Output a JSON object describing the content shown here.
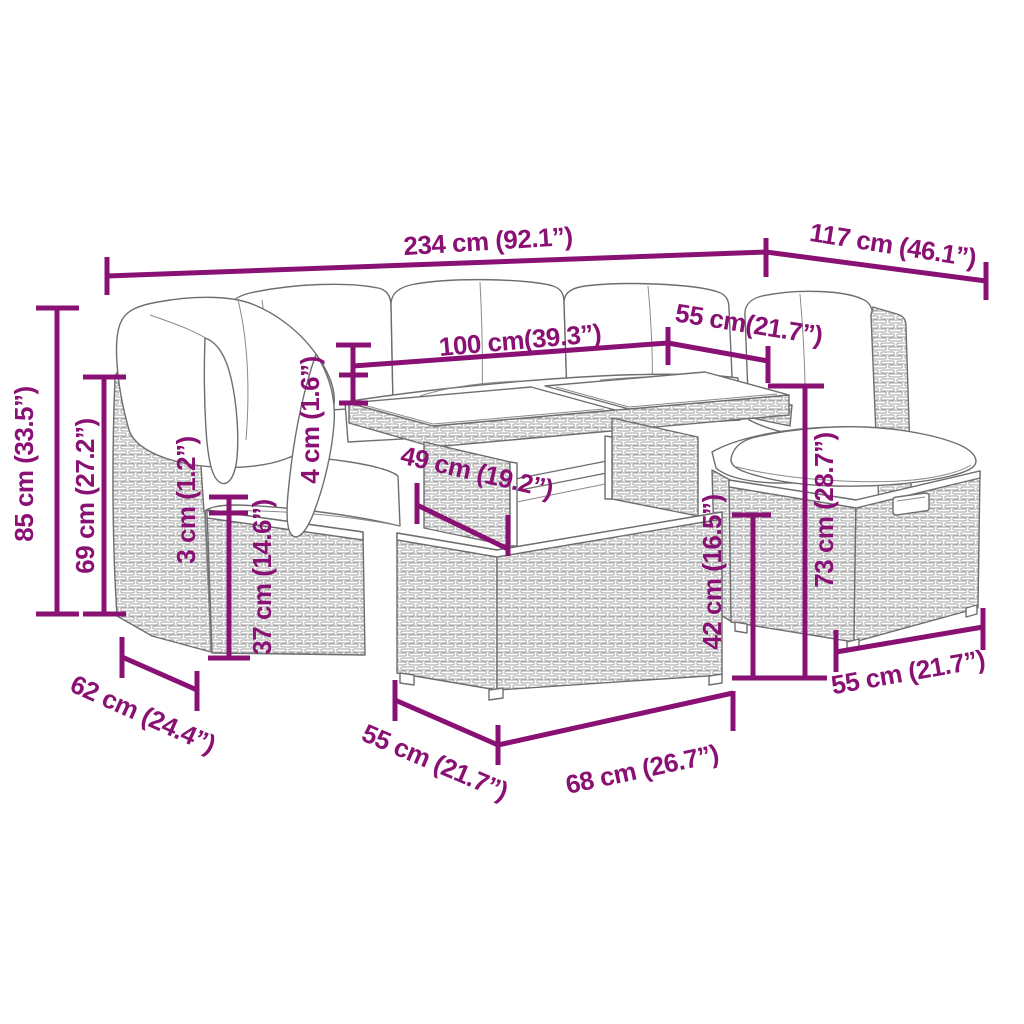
{
  "diagram": {
    "title": "outdoor-rattan-lounge-set-dimension-diagram",
    "background": "#ffffff",
    "dimension_color": "#8a1174",
    "line_art_color": "#6e6e6e",
    "texture_color": "#a3a3a3",
    "unit_style": "cm (inches)"
  },
  "dimensions": [
    {
      "id": "total-width",
      "label": "234 cm (92.1”)",
      "segments": [
        [
          107,
          276,
          766,
          252
        ],
        [
          107,
          257,
          107,
          295
        ],
        [
          766,
          238,
          766,
          277
        ]
      ],
      "text": {
        "x": 488,
        "y": 241,
        "rot": -3.5
      }
    },
    {
      "id": "total-depth-right",
      "label": "117 cm (46.1”)",
      "segments": [
        [
          766,
          252,
          986,
          281
        ],
        [
          986,
          262,
          986,
          300
        ]
      ],
      "text": {
        "x": 893,
        "y": 245,
        "rot": 9
      }
    },
    {
      "id": "table-length",
      "label": "100 cm(39.3”)",
      "segments": [
        [
          353,
          366,
          668,
          343
        ],
        [
          353,
          345,
          353,
          403
        ],
        [
          336,
          345,
          371,
          345
        ],
        [
          668,
          327,
          668,
          365
        ]
      ],
      "text": {
        "x": 520,
        "y": 340,
        "rot": -5
      }
    },
    {
      "id": "seat-depth-top",
      "label": "55 cm(21.7”)",
      "segments": [
        [
          668,
          343,
          768,
          361
        ],
        [
          768,
          346,
          768,
          383
        ]
      ],
      "text": {
        "x": 749,
        "y": 324,
        "rot": 9
      }
    },
    {
      "id": "tabletop-thickness",
      "label": "4 cm (1.6”)",
      "segments": [
        [
          339,
          375,
          368,
          375
        ],
        [
          339,
          403,
          368,
          403
        ]
      ],
      "text": {
        "x": 310,
        "y": 420,
        "rot": -90
      }
    },
    {
      "id": "back-height",
      "label": "85 cm (33.5”)",
      "segments": [
        [
          57,
          308,
          57,
          614
        ],
        [
          36,
          308,
          79,
          308
        ],
        [
          36,
          614,
          79,
          614
        ]
      ],
      "text": {
        "x": 24,
        "y": 464,
        "rot": -90
      }
    },
    {
      "id": "back-height-inner",
      "label": "69 cm (27.2”)",
      "segments": [
        [
          104,
          377,
          104,
          614
        ],
        [
          83,
          377,
          126,
          377
        ],
        [
          83,
          614,
          126,
          614
        ]
      ],
      "text": {
        "x": 85,
        "y": 496,
        "rot": -90
      }
    },
    {
      "id": "cushion-thickness",
      "label": "3 cm (1.2”)",
      "segments": [
        [
          229,
          497,
          229,
          513
        ],
        [
          209,
          497,
          248,
          497
        ],
        [
          209,
          513,
          248,
          513
        ]
      ],
      "text": {
        "x": 186,
        "y": 500,
        "rot": -90
      }
    },
    {
      "id": "seat-frame-height",
      "label": "37 cm (14.6”)",
      "segments": [
        [
          229,
          513,
          229,
          658
        ],
        [
          208,
          658,
          250,
          658
        ]
      ],
      "text": {
        "x": 262,
        "y": 577,
        "rot": -90
      }
    },
    {
      "id": "table-depth",
      "label": "49 cm (19.2”)",
      "segments": [
        [
          417,
          505,
          508,
          549
        ],
        [
          417,
          483,
          417,
          524
        ],
        [
          508,
          515,
          508,
          556
        ]
      ],
      "text": {
        "x": 477,
        "y": 472,
        "rot": 13
      }
    },
    {
      "id": "stool-height",
      "label": "42 cm (16.5”)",
      "segments": [
        [
          753,
          515,
          753,
          678
        ],
        [
          732,
          515,
          771,
          515
        ],
        [
          732,
          678,
          827,
          678
        ]
      ],
      "text": {
        "x": 712,
        "y": 572,
        "rot": -90
      }
    },
    {
      "id": "table-height",
      "label": "73 cm (28.7”)",
      "segments": [
        [
          805,
          386,
          805,
          678
        ],
        [
          768,
          386,
          824,
          386
        ]
      ],
      "text": {
        "x": 824,
        "y": 510,
        "rot": -90
      }
    },
    {
      "id": "module-depth",
      "label": "62 cm (24.4”)",
      "segments": [
        [
          122,
          657,
          197,
          690
        ],
        [
          122,
          637,
          122,
          678
        ],
        [
          197,
          671,
          197,
          711
        ]
      ],
      "text": {
        "x": 143,
        "y": 714,
        "rot": 24
      }
    },
    {
      "id": "table-base-depth",
      "label": "55 cm (21.7”)",
      "segments": [
        [
          395,
          700,
          498,
          745
        ],
        [
          395,
          680,
          395,
          721
        ],
        [
          498,
          725,
          498,
          765
        ]
      ],
      "text": {
        "x": 435,
        "y": 762,
        "rot": 23
      }
    },
    {
      "id": "table-base-length",
      "label": "68 cm (26.7”)",
      "segments": [
        [
          498,
          745,
          733,
          693
        ],
        [
          733,
          691,
          733,
          731
        ]
      ],
      "text": {
        "x": 642,
        "y": 769,
        "rot": -12
      }
    },
    {
      "id": "stool-depth",
      "label": "55 cm (21.7”)",
      "segments": [
        [
          836,
          652,
          983,
          627
        ],
        [
          836,
          630,
          836,
          672
        ],
        [
          983,
          608,
          983,
          650
        ]
      ],
      "text": {
        "x": 908,
        "y": 672,
        "rot": -10
      }
    }
  ]
}
